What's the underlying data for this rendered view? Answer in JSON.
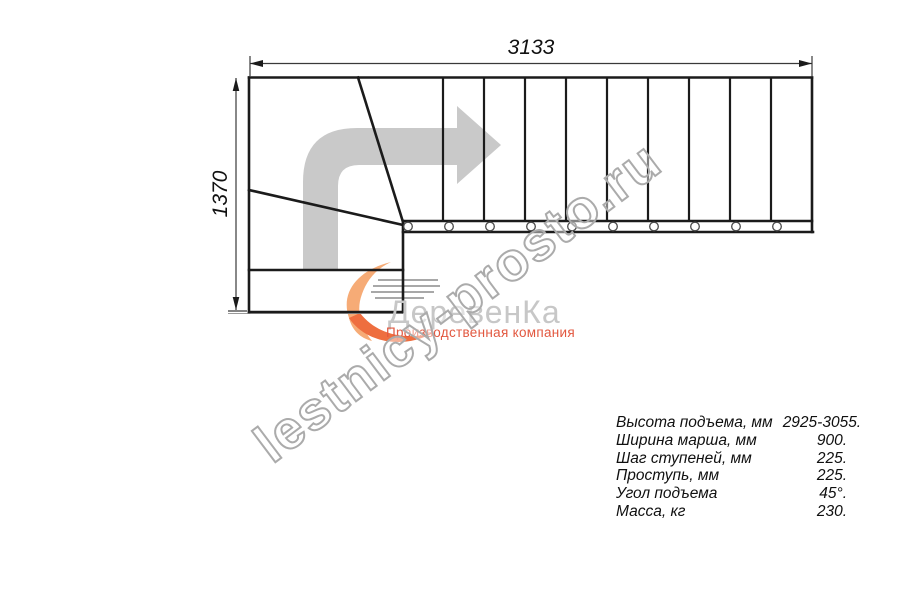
{
  "drawing": {
    "width_label": "3133",
    "height_label": "1370"
  },
  "watermark": {
    "text": "lestnicy-prosto.ru",
    "outline_color": "#ababab"
  },
  "logo": {
    "wordmark": "ДеревенКа",
    "tagline": "Производственная компания",
    "wordmark_color": "#c7c7c7",
    "tagline_color": "#e2573f",
    "swirl_colors": [
      "#f6ab76",
      "#ee6e3f"
    ]
  },
  "plan": {
    "arrow_color": "#c9c9c9",
    "line_color": "#1b1b1b"
  },
  "icons": {
    "direction_arrow": "stair-direction-arrow-icon (L-shaped gray arrow, up then right)",
    "baluster_marker": "baluster-circle-icon (small white circles along stringer)",
    "logo_swirl": "logo-swirl-icon (orange wood-shaving swirl)"
  },
  "specs": {
    "rows": [
      {
        "label": "Высота подъема, мм",
        "value": "2925-3055."
      },
      {
        "label": "Ширина марша, мм",
        "value": "900."
      },
      {
        "label": "Шаг ступеней, мм",
        "value": "225."
      },
      {
        "label": "Проступь, мм",
        "value": "225."
      },
      {
        "label": "Угол подъема",
        "value": "45°."
      },
      {
        "label": "Масса, кг",
        "value": "230."
      }
    ]
  }
}
